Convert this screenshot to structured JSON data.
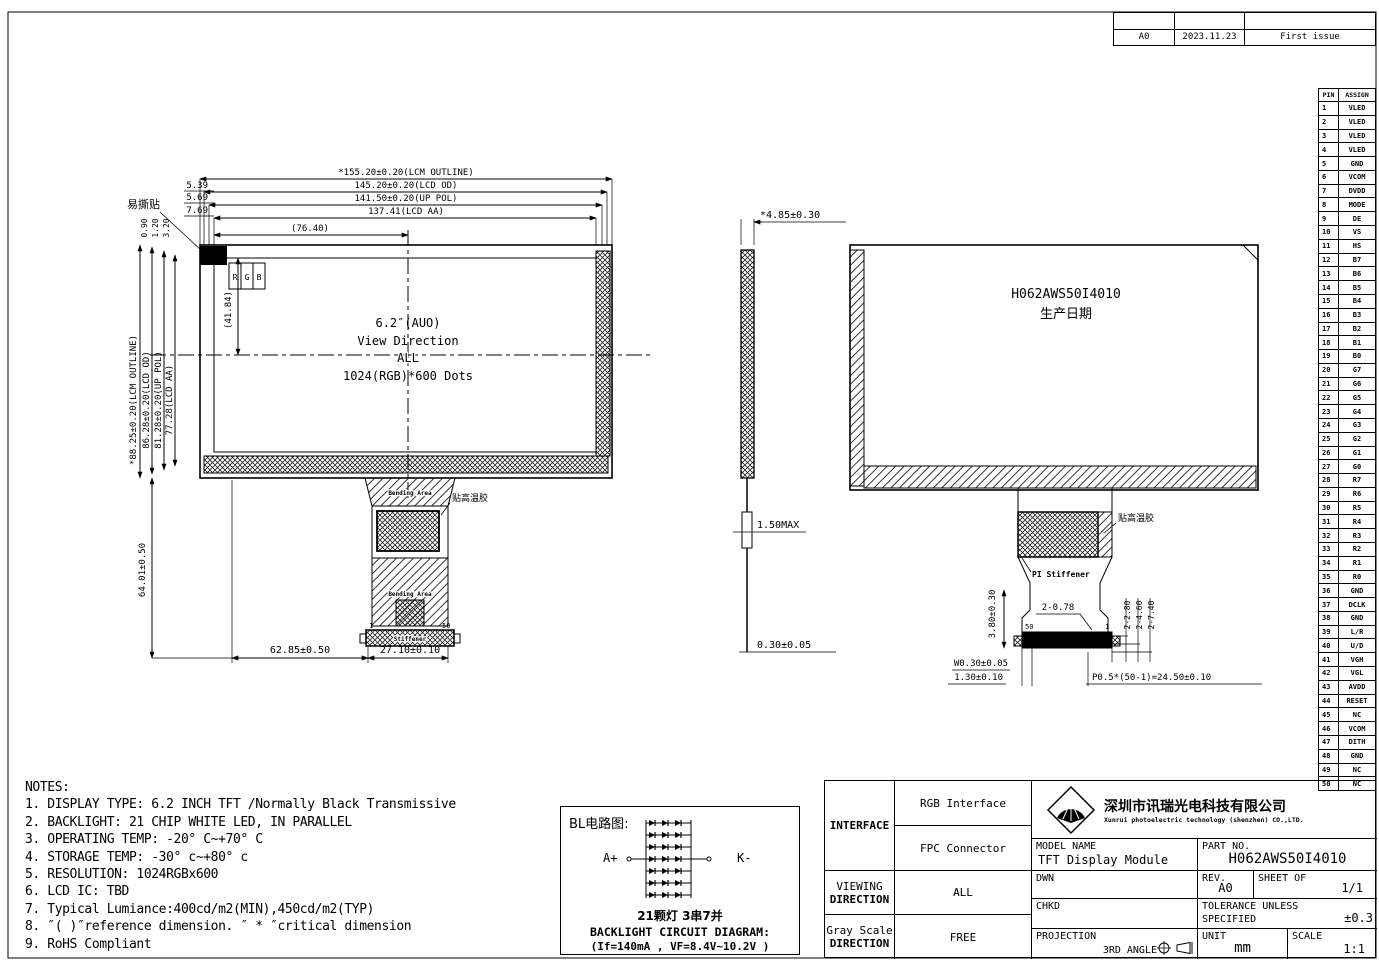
{
  "revision_table": {
    "rows": [
      {
        "rev": "",
        "date": "",
        "desc": ""
      },
      {
        "rev": "A0",
        "date": "2023.11.23",
        "desc": "First issue"
      }
    ]
  },
  "pin_table": {
    "header_pin": "PIN",
    "header_assign": "ASSIGN",
    "rows": [
      {
        "pin": "1",
        "assign": "VLED"
      },
      {
        "pin": "2",
        "assign": "VLED"
      },
      {
        "pin": "3",
        "assign": "VLED"
      },
      {
        "pin": "4",
        "assign": "VLED"
      },
      {
        "pin": "5",
        "assign": "GND"
      },
      {
        "pin": "6",
        "assign": "VCOM"
      },
      {
        "pin": "7",
        "assign": "DVDD"
      },
      {
        "pin": "8",
        "assign": "MODE"
      },
      {
        "pin": "9",
        "assign": "DE"
      },
      {
        "pin": "10",
        "assign": "VS"
      },
      {
        "pin": "11",
        "assign": "HS"
      },
      {
        "pin": "12",
        "assign": "B7"
      },
      {
        "pin": "13",
        "assign": "B6"
      },
      {
        "pin": "14",
        "assign": "B5"
      },
      {
        "pin": "15",
        "assign": "B4"
      },
      {
        "pin": "16",
        "assign": "B3"
      },
      {
        "pin": "17",
        "assign": "B2"
      },
      {
        "pin": "18",
        "assign": "B1"
      },
      {
        "pin": "19",
        "assign": "B0"
      },
      {
        "pin": "20",
        "assign": "G7"
      },
      {
        "pin": "21",
        "assign": "G6"
      },
      {
        "pin": "22",
        "assign": "G5"
      },
      {
        "pin": "23",
        "assign": "G4"
      },
      {
        "pin": "24",
        "assign": "G3"
      },
      {
        "pin": "25",
        "assign": "G2"
      },
      {
        "pin": "26",
        "assign": "G1"
      },
      {
        "pin": "27",
        "assign": "G0"
      },
      {
        "pin": "28",
        "assign": "R7"
      },
      {
        "pin": "29",
        "assign": "R6"
      },
      {
        "pin": "30",
        "assign": "R5"
      },
      {
        "pin": "31",
        "assign": "R4"
      },
      {
        "pin": "32",
        "assign": "R3"
      },
      {
        "pin": "33",
        "assign": "R2"
      },
      {
        "pin": "34",
        "assign": "R1"
      },
      {
        "pin": "35",
        "assign": "R0"
      },
      {
        "pin": "36",
        "assign": "GND"
      },
      {
        "pin": "37",
        "assign": "DCLK"
      },
      {
        "pin": "38",
        "assign": "GND"
      },
      {
        "pin": "39",
        "assign": "L/R"
      },
      {
        "pin": "40",
        "assign": "U/D"
      },
      {
        "pin": "41",
        "assign": "VGH"
      },
      {
        "pin": "42",
        "assign": "VGL"
      },
      {
        "pin": "43",
        "assign": "AVDD"
      },
      {
        "pin": "44",
        "assign": "RESET"
      },
      {
        "pin": "45",
        "assign": "NC"
      },
      {
        "pin": "46",
        "assign": "VCOM"
      },
      {
        "pin": "47",
        "assign": "DITH"
      },
      {
        "pin": "48",
        "assign": "GND"
      },
      {
        "pin": "49",
        "assign": "NC"
      },
      {
        "pin": "50",
        "assign": "NC"
      }
    ]
  },
  "front_view": {
    "tear_sticker": "易撕贴",
    "rgb_r": "R",
    "rgb_g": "G",
    "rgb_b": "B",
    "dim_lcm_outline_h": "*155.20±0.20(LCM OUTLINE)",
    "dim_lcd_od_h": "145.20±0.20(LCD OD)",
    "dim_up_pol_h": "141.50±0.20(UP POL)",
    "dim_lcd_aa_h": "137.41(LCD AA)",
    "dim_center_h": "(76.40)",
    "dim_539": "5.39",
    "dim_569": "5.69",
    "dim_769": "7.69",
    "dim_090": "0.90",
    "dim_120": "1.20",
    "dim_320": "3.20",
    "dim_lcm_outline_v": "*88.25±0.20(LCM OUTLINE)",
    "dim_lcd_od_v": "86.28±0.20(LCD OD)",
    "dim_up_pol_v": "81.28±0.20(UP POL)",
    "dim_lcd_aa_v": "77.28(LCD AA)",
    "dim_center_v": "(41.84)",
    "dim_6401": "64.01±0.50",
    "dim_6285": "62.85±0.50",
    "dim_2710": "27.10±0.10",
    "center_text": [
      "6.2″(AUO)",
      "View Direction",
      "ALL",
      "1024(RGB)*600 Dots"
    ],
    "label_tape": "贴高温胶",
    "label_bending_top": "Bending Area",
    "label_bending_bottom": "Bending Area",
    "label_stiffener": "Stiffener",
    "pin1": "1",
    "pin50": "50"
  },
  "side_view": {
    "dim_thickness": "*4.85±0.30",
    "dim_150max": "1.50MAX",
    "dim_030": "0.30±0.05"
  },
  "back_view": {
    "part_no": "H062AWS50I4010",
    "prod_date": "生产日期",
    "label_tape": "贴高温胶",
    "label_pi_stiffener": "PI Stiffener",
    "dim_380": "3.80±0.30",
    "dim_2_078": "2-0.78",
    "dim_2_280": "2-2.80",
    "dim_2_460": "2-4.60",
    "dim_2_740": "2-7.40",
    "dim_w030": "W0.30±0.05",
    "dim_130": "1.30±0.10",
    "dim_pitch": "P0.5*(50-1)=24.50±0.10",
    "pin50": "50",
    "pin1": "1"
  },
  "notes": {
    "title": "NOTES:",
    "items": [
      "1. DISPLAY TYPE: 6.2 INCH TFT /Normally Black Transmissive",
      "2. BACKLIGHT: 21 CHIP WHITE LED, IN PARALLEL",
      "3. OPERATING TEMP: -20° C~+70° C",
      "4. STORAGE TEMP: -30° c~+80° c",
      "5. RESOLUTION: 1024RGBx600",
      "6. LCD IC: TBD",
      "7. Typical Lumiance:400cd/m2(MIN),450cd/m2(TYP)",
      "8. ″( )″reference dimension. ″ * ″critical dimension",
      "9. RoHS Compliant"
    ]
  },
  "bl_circuit": {
    "title": "BL电路图:",
    "anode": "A+",
    "cathode": "K-",
    "led_config": "21颗灯 3串7并",
    "caption1": "BACKLIGHT CIRCUIT DIAGRAM:",
    "caption2": "(If=140mA ,  VF=8.4V~10.2V )"
  },
  "title_block": {
    "interface_label": "INTERFACE",
    "interface_val1": "RGB Interface",
    "interface_val2": "FPC Connector",
    "viewing_label1": "VIEWING",
    "viewing_label2": "DIRECTION",
    "viewing_val": "ALL",
    "gray_label1": "Gray Scale",
    "gray_label2": "DIRECTION",
    "gray_val": "FREE",
    "company_cn": "深圳市讯瑞光电科技有限公司",
    "company_en": "Xunrui photoelectric technology (shenzhen) CO.,LTD.",
    "model_name_label": "MODEL NAME",
    "model_name": "TFT Display Module",
    "part_no_label": "PART NO.",
    "part_no": "H062AWS50I4010",
    "dwn_label": "DWN",
    "rev_label": "REV.",
    "rev": "A0",
    "sheet_label": "SHEET OF",
    "sheet": "1/1",
    "chkd_label": "CHKD",
    "tol_label1": "TOLERANCE UNLESS",
    "tol_label2": "SPECIFIED",
    "tol": "±0.3",
    "proj_label": "PROJECTION",
    "proj_val": "3RD ANGLE",
    "unit_label": "UNIT",
    "unit": "mm",
    "scale_label": "SCALE",
    "scale": "1:1"
  }
}
